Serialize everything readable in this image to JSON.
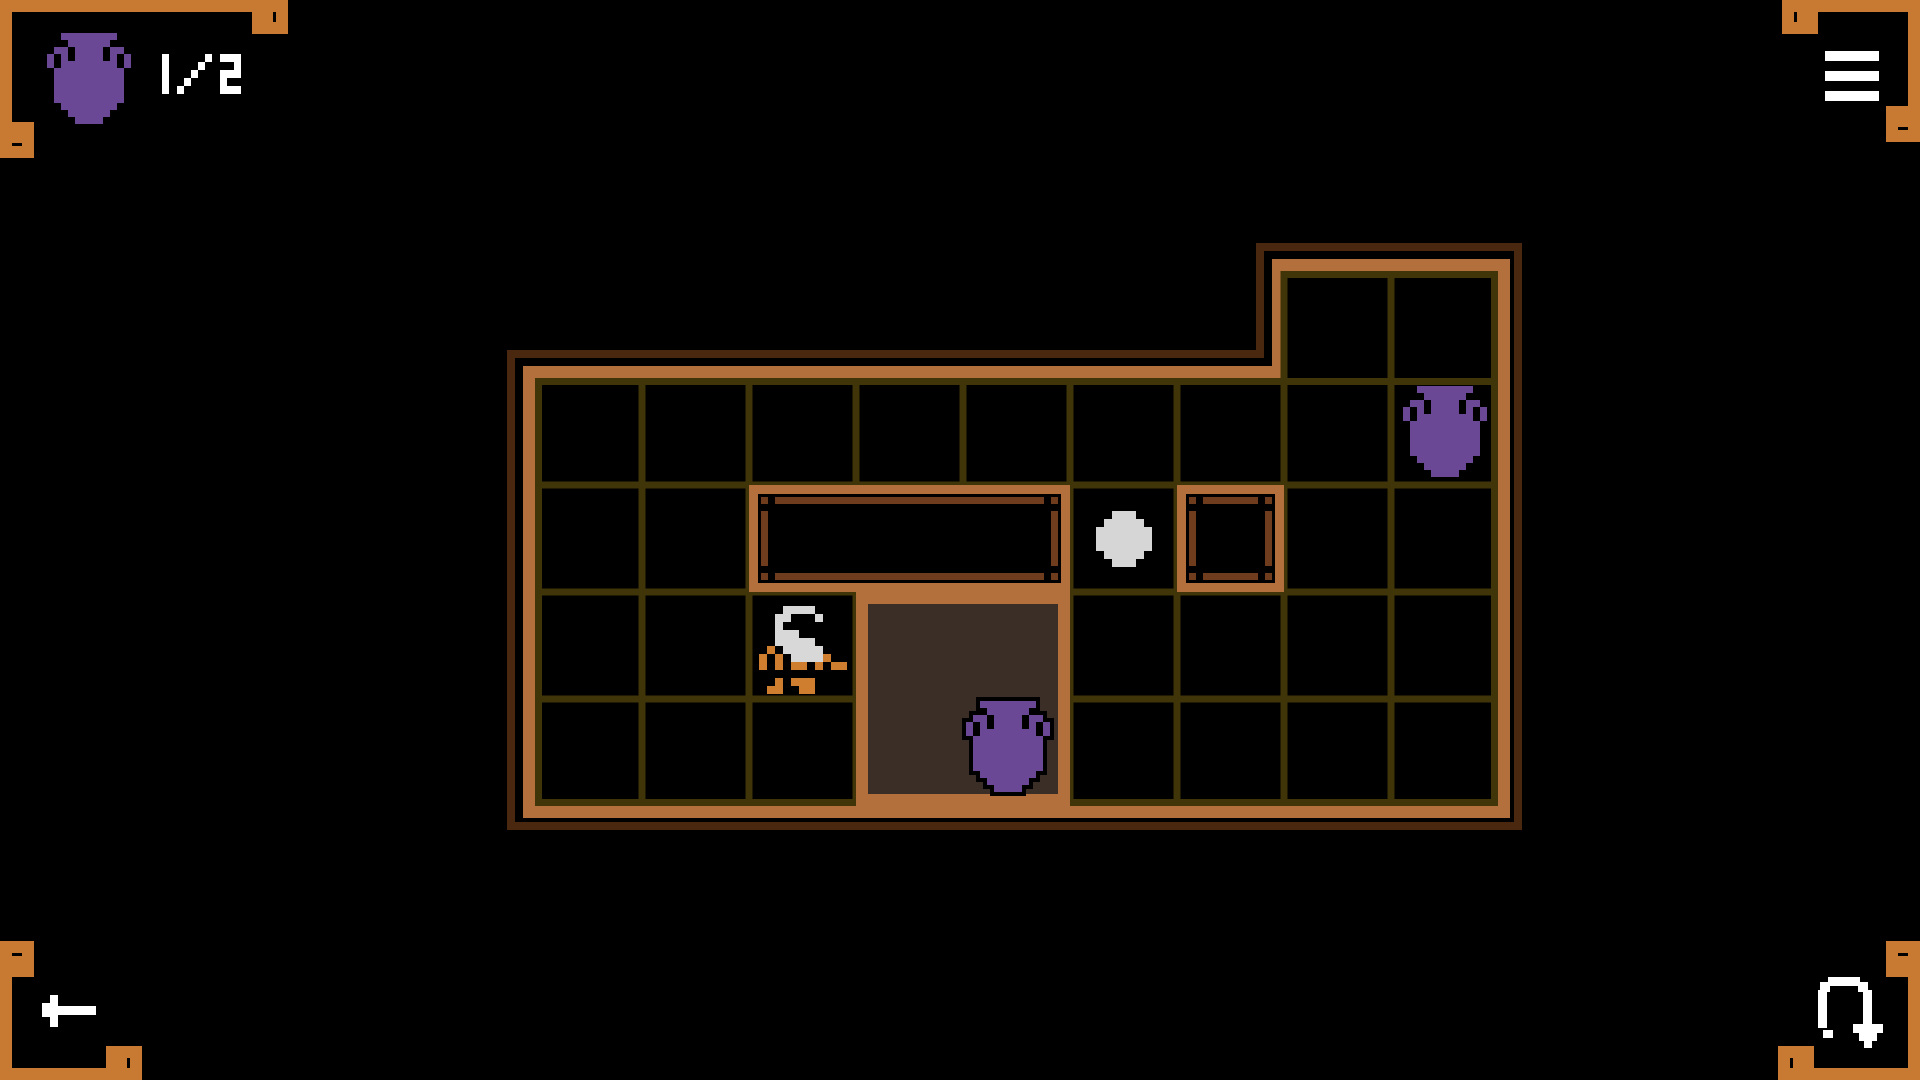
{
  "hud": {
    "vase_counter": {
      "icon": "amphora-icon",
      "value": "1/2"
    },
    "menu_button": {
      "icon": "menu-icon"
    },
    "back_button": {
      "icon": "back-arrow-icon"
    },
    "undo_button": {
      "icon": "undo-icon"
    }
  },
  "colors": {
    "background": "#000000",
    "frame_orange": "#c87a33",
    "board_orange": "#b4703c",
    "board_outline": "#4a2810",
    "grid_line": "#403409",
    "wall_inner": "#6f3d1e",
    "pit_fill": "#3b2e26",
    "amphora_purple": "#6b4896",
    "player_orange": "#cf7d2e",
    "player_white": "#d8d8d8",
    "ball_white": "#d6d6d6",
    "hud_white": "#ffffff",
    "outline_black": "#000000"
  },
  "board": {
    "cols": 9,
    "rows": 4,
    "cell_size": 107,
    "origin": {
      "x": 535,
      "y": 378
    },
    "extension": {
      "start_col": 7,
      "cols": 2,
      "rows": 1
    },
    "walls": [
      {
        "name": "wall-long",
        "col": 2,
        "row": 1,
        "w": 3,
        "h": 1
      },
      {
        "name": "wall-small",
        "col": 6,
        "row": 1,
        "w": 1,
        "h": 1
      }
    ],
    "pit": {
      "col": 3,
      "row": 2,
      "w": 2,
      "h": 2
    },
    "entities": [
      {
        "name": "amphora-on-floor",
        "sprite": "amphora",
        "col": 8,
        "row": 0
      },
      {
        "name": "amphora-in-pit",
        "sprite": "amphora",
        "x": 966,
        "y": 701,
        "outlined": true
      },
      {
        "name": "boulder",
        "sprite": "ball",
        "col": 5,
        "row": 1
      },
      {
        "name": "player",
        "sprite": "player",
        "col": 2,
        "row": 2
      }
    ]
  },
  "sprites": {
    "amphora": {
      "pixel": 7,
      "map": [
        "..########..",
        "...######...",
        ".##.####.##.",
        "#.#.####.#.#",
        "#.########.#",
        ".##########.",
        ".##########.",
        ".##########.",
        ".##########.",
        ".##########.",
        "..########..",
        "...######...",
        "....####...."
      ]
    },
    "player": {
      "pixel": 8,
      "map": [
        ".............",
        "....WWWW.....",
        "...WW...W....",
        "...W.........",
        "...WWW.......",
        "...WWWWW.....",
        "..O.WWWWW....",
        ".O.O.WWWWO...",
        ".O.O.OO.O.OO.",
        ".............",
        "...O.OOO.....",
        "..OO..OO....."
      ]
    },
    "ball": {
      "pixel": 8,
      "map": [
        "..###..",
        ".#####.",
        "#######",
        "#######",
        "#######",
        ".#####.",
        "..###.."
      ]
    }
  },
  "glyphs": {
    "1": [
      "#",
      "#",
      "#",
      "#",
      "#"
    ],
    "/": [
      "....#",
      "...#.",
      "..#..",
      ".#...",
      "#...."
    ],
    "2": [
      "###",
      "..#",
      "###",
      "#..",
      "###"
    ]
  }
}
